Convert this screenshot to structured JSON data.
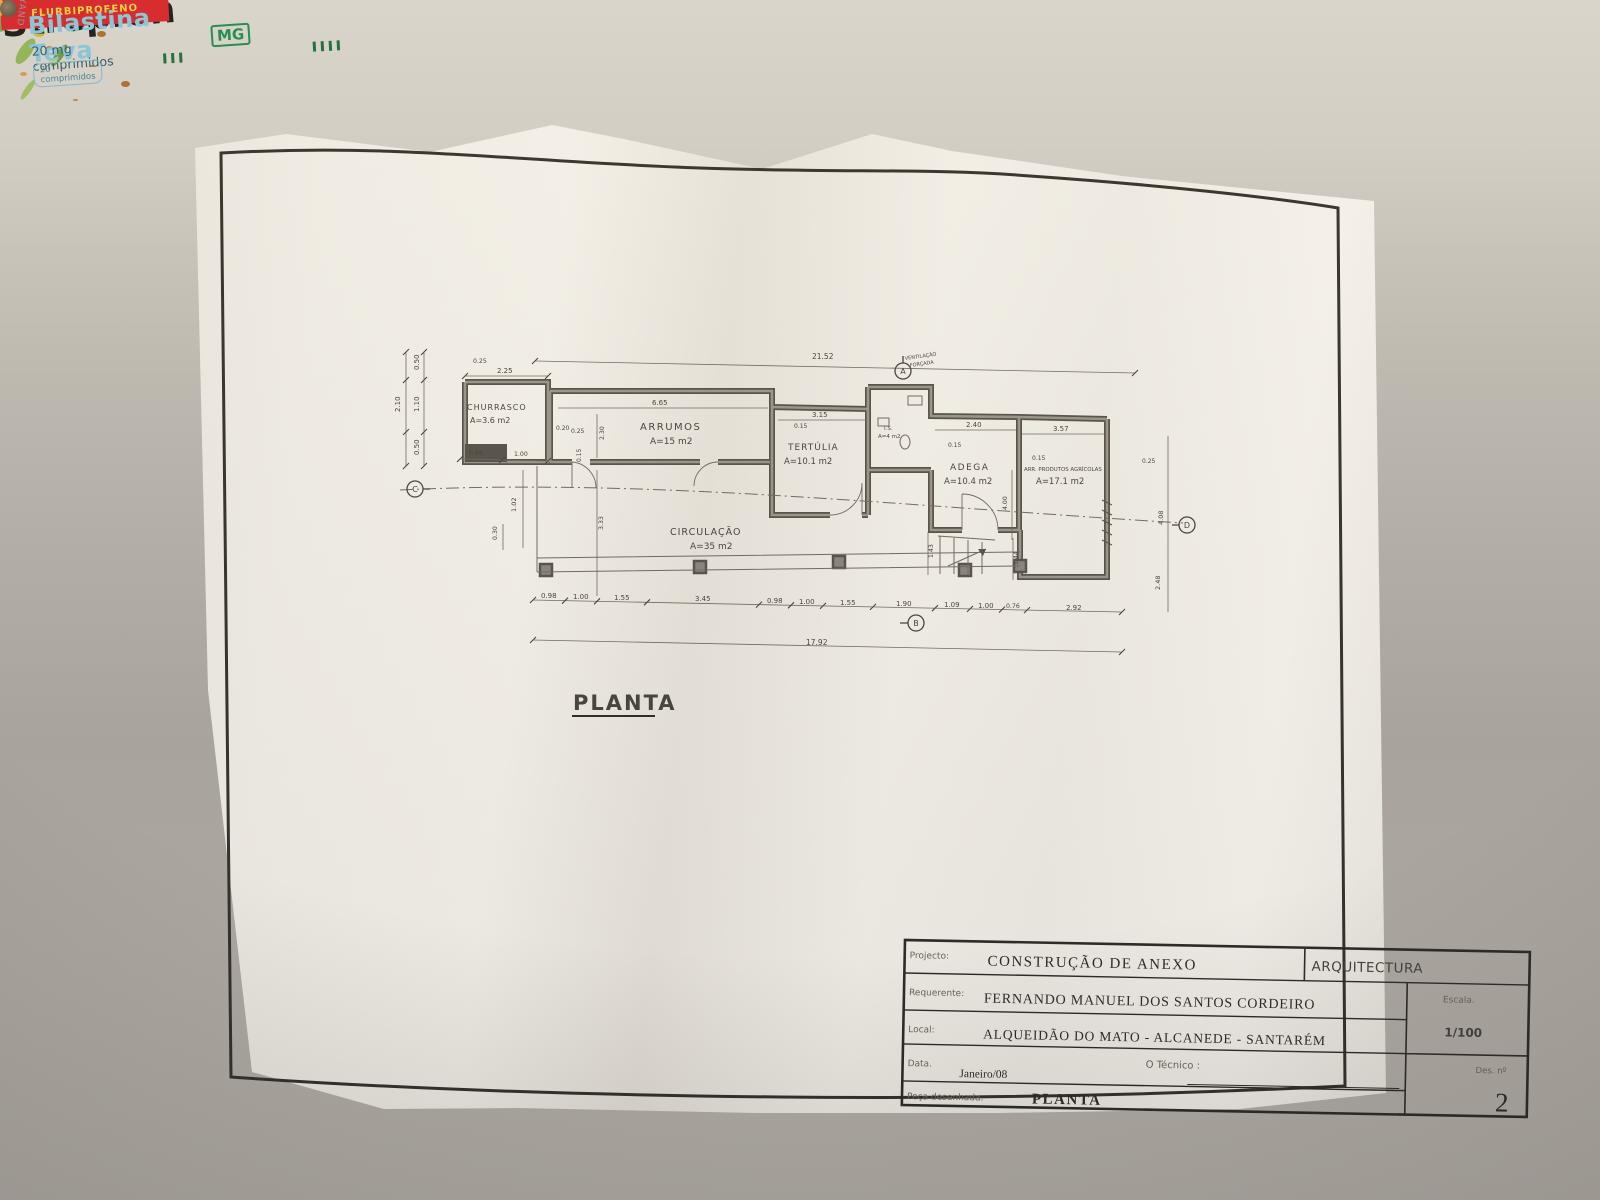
{
  "plan": {
    "sheet_title": "PLANTA",
    "note_line1": "VENTILAÇÃO",
    "note_line2": "FORÇADA",
    "rooms": {
      "churrasco": {
        "name": "CHURRASCO",
        "area": "A=3.6 m2"
      },
      "arrumos": {
        "name": "ARRUMOS",
        "area": "A=15 m2"
      },
      "tertulia": {
        "name": "TERTÚLIA",
        "area": "A=10.1 m2"
      },
      "is": {
        "name": "I.S.",
        "area": "A=4 m2"
      },
      "adega": {
        "name": "ADEGA",
        "area": "A=10.4 m2"
      },
      "arrprod": {
        "name": "ARR. PRODUTOS AGRÍCOLAS",
        "area": "A=17.1 m2"
      },
      "circulacao": {
        "name": "CIRCULAÇÃO",
        "area": "A=35 m2"
      }
    },
    "markers": {
      "top": "A",
      "bottom": "B",
      "left": "C",
      "right": "D"
    },
    "dims": {
      "top_total": "21.52",
      "bottom_total": "17.92",
      "churrasco_w": "2.25",
      "arrumos_w": "6.65",
      "tertulia_w": "3.15",
      "adega_w": "2.40",
      "arrprod_w": "3.57",
      "bottom_chain": [
        "0.98",
        "1.00",
        "1.55",
        "3.45",
        "0.98",
        "1.00",
        "1.55",
        "1.90",
        "1.09",
        "1.00",
        "0.76",
        "2.92"
      ],
      "left_total": "2.10",
      "left_chain": [
        "0.50",
        "1.10",
        "0.50"
      ],
      "misc": {
        "p025a": "0.25",
        "p025b": "0.25",
        "p025c": "0.25",
        "p020": "0.20",
        "p015a": "0.15",
        "p015b": "0.15",
        "p015c": "0.15",
        "p015d": "0.15",
        "p230": "2.30",
        "p333": "3.33",
        "p102": "1.02",
        "p030": "0.30",
        "p066": "0.66",
        "p100": "1.00",
        "p143": "1.43",
        "p144": "1.44",
        "p400": "4.00",
        "p408": "4.08",
        "p248": "2.48"
      }
    }
  },
  "titleblock": {
    "projecto_label": "Projecto:",
    "projecto_value": "CONSTRUÇÃO DE ANEXO",
    "discipline": "ARQUITECTURA",
    "requerente_label": "Requerente:",
    "requerente_value": "FERNANDO MANUEL DOS SANTOS CORDEIRO",
    "escala_label": "Escala.",
    "escala_value": "1/100",
    "local_label": "Local:",
    "local_value": "ALQUEIDÃO DO MATO - ALCANEDE - SANTARÉM",
    "data_label": "Data.",
    "data_value": "Janeiro/08",
    "tecnico_label": "O Técnico :",
    "des_label": "Des. nº",
    "des_value": "2",
    "peca_label": "Peça desenhada.",
    "peca_value": "PLANTA"
  },
  "objects": {
    "strepfen": {
      "brand": "Strepfen",
      "active": "FLURBIPROFENO"
    },
    "bilastina": {
      "brand": "Bilastina Teva",
      "dose": "20 mg comprimidos",
      "logo": "MG",
      "count": "20 comprimidos",
      "badge": "20"
    },
    "sparklers": {
      "brand": "Wunderkerzen",
      "line1": "Electric",
      "line2": "Sparklers",
      "line3": "Julgransbloss",
      "edge_letter": "P"
    },
    "scissors": {
      "brand": "DAYAND"
    }
  },
  "colors": {
    "paper": "#f3f0ea",
    "ink": "#2c2a26",
    "sparkler_blue": "#1f3d8f",
    "sparkler_red": "#cd2630",
    "bilastina_teal": "#85c5d9",
    "mg_green": "#1d8a4c",
    "strepfen_red": "#d5232a",
    "folder_blue": "#2f6fd0",
    "lid_green": "#1f8a45"
  }
}
